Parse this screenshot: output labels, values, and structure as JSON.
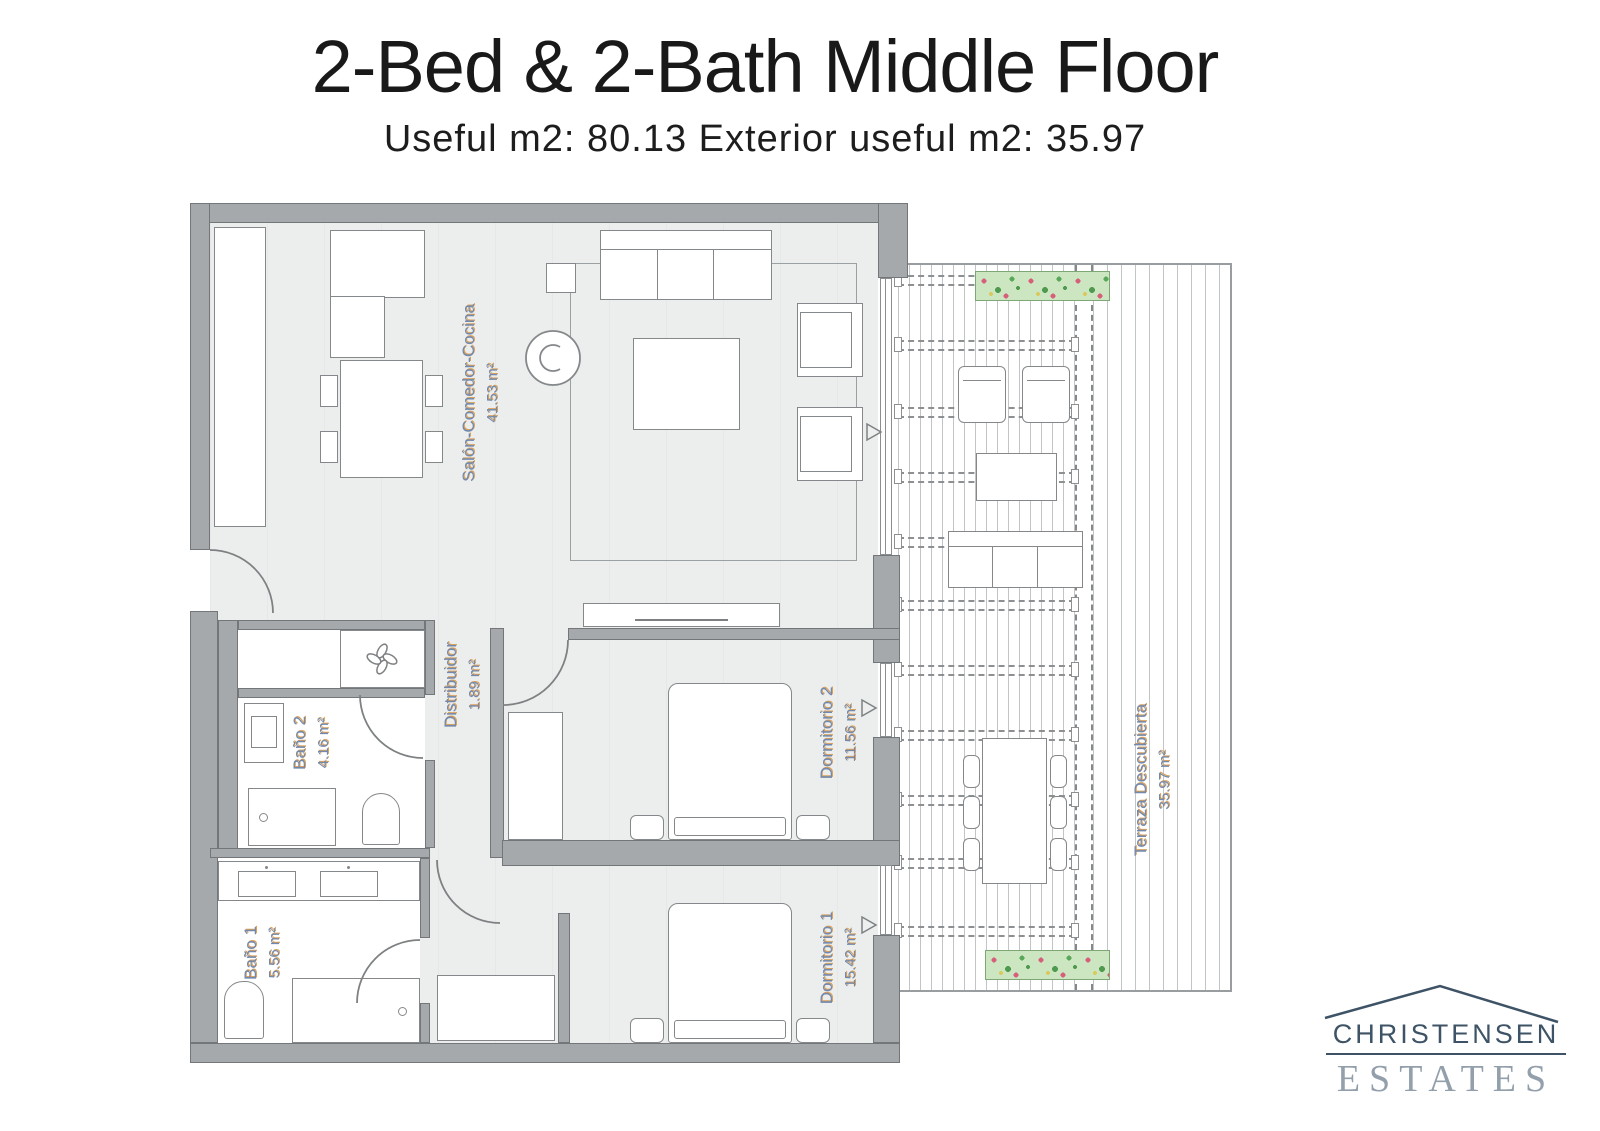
{
  "header": {
    "title": "2-Bed & 2-Bath Middle Floor",
    "subtitle": "Useful m2: 80.13 Exterior useful m2: 35.97"
  },
  "floorplan": {
    "rooms": [
      {
        "name": "Salón-Comedor-Cocina",
        "area": "41.53 m²"
      },
      {
        "name": "Distribuidor",
        "area": "1.89 m²"
      },
      {
        "name": "Baño 2",
        "area": "4.16 m²"
      },
      {
        "name": "Baño 1",
        "area": "5.56 m²"
      },
      {
        "name": "Dormitorio 2",
        "area": "11.56 m²"
      },
      {
        "name": "Dormitorio 1",
        "area": "15.42 m²"
      },
      {
        "name": "Terraza Descubierta",
        "area": "35.97 m²"
      }
    ],
    "colors": {
      "wall": "#a6a9ab",
      "label": "#7289ad",
      "label_shadow": "#d8a15e",
      "planter": "#cde6c2",
      "deck_line": "#c2c5c6"
    }
  },
  "logo": {
    "name": "CHRISTENSEN",
    "type": "ESTATES"
  }
}
